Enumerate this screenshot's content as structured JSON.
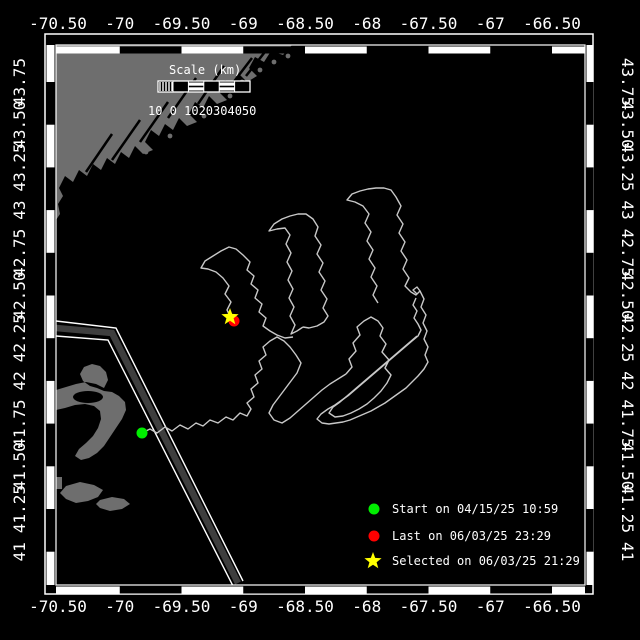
{
  "map": {
    "bg_color": "#000000",
    "land_color": "#6e6e6e",
    "track_color": "#c8c8c8",
    "lane_color": "#3e3e3e",
    "frame_color": "#ffffff",
    "plot": {
      "x0": 56,
      "y0": 45,
      "x1": 585,
      "y1": 585
    },
    "lon_axis": {
      "tick_values": [
        -70.5,
        -70,
        -69.5,
        -69,
        -68.5,
        -68,
        -67.5,
        -67,
        -66.5
      ],
      "tick_labels": [
        "-70.50",
        "-70",
        "-69.50",
        "-69",
        "-68.50",
        "-68",
        "-67.50",
        "-67",
        "-66.50"
      ],
      "x_of_first_tick": 58,
      "px_per_degree": 123.5
    },
    "lat_axis": {
      "tick_values": [
        43.75,
        43.5,
        43.25,
        43,
        42.75,
        42.5,
        42.25,
        42,
        41.75,
        41.5,
        41.25,
        41
      ],
      "tick_labels": [
        "43.75",
        "43.50",
        "43.25",
        "43",
        "42.75",
        "42.50",
        "42.25",
        "42",
        "41.75",
        "41.50",
        "41.25",
        "41"
      ],
      "y_of_first_tick": 82,
      "px_per_degree": 170.8
    }
  },
  "scale_bar": {
    "title": "Scale (km)",
    "numbers": "10 0 1020304050",
    "bar": {
      "x": 158,
      "y": 81,
      "w": 92,
      "h": 11,
      "segments": 5
    }
  },
  "legend": {
    "items": [
      {
        "marker": "circle",
        "color": "#00ee00",
        "label": "Start on 04/15/25 10:59"
      },
      {
        "marker": "circle",
        "color": "#ff0000",
        "label": "Last on 06/03/25 23:29"
      },
      {
        "marker": "star",
        "color": "#ffff00",
        "label": "Selected on 06/03/25 21:29"
      }
    ],
    "marker_x": 374,
    "text_x": 392,
    "row_y": [
      509,
      536,
      561
    ]
  },
  "markers": {
    "start": {
      "x": 142,
      "y": 433,
      "color": "#00ee00"
    },
    "last": {
      "x": 234,
      "y": 321,
      "color": "#ff0000"
    },
    "selected": {
      "x": 230,
      "y": 317,
      "color": "#ffff00"
    }
  },
  "shoreline": {
    "maine_path": "M56,45 L292,45 L283,55 271,51 264,62 255,57 249,68 257,76 247,82 239,74 233,86 225,80 219,92 227,100 217,104 209,96 203,108 195,102 189,114 197,122 187,126 179,118 173,130 165,124 159,136 151,130 145,142 153,150 143,154 135,146 129,158 121,152 115,164 107,158 101,170 93,164 87,176 79,170 73,182 65,176 59,188 63,196 58,204 60,214 56,220 Z",
    "cape_cod_path": "M56,390 L66,387 76,384 86,382 96,384 104,388 108,380 106,372 100,366 92,364 84,367 80,374 83,381 90,386 97,388 104,391 112,392 119,396 125,402 126,410 122,419 116,428 110,437 104,446 97,453 89,458 81,460 75,456 79,449 86,443 93,436 98,428 101,419 100,411 94,406 85,404 75,405 65,408 56,410 Z",
    "bay_cut": {
      "cx": 88,
      "cy": 397,
      "rx": 15,
      "ry": 6
    },
    "islands_south": [
      "M66,486 L80,482 94,485 103,490 98,497 88,501 76,503 66,499 60,493 Z",
      "M100,500 L112,497 124,499 130,504 122,509 110,511 100,508 96,504 Z",
      "M50,477 L62,477 62,489 50,489 Z"
    ],
    "coast_islands": [
      [
        260,
        70
      ],
      [
        274,
        62
      ],
      [
        288,
        56
      ],
      [
        300,
        50
      ],
      [
        242,
        82
      ],
      [
        230,
        96
      ],
      [
        204,
        116
      ],
      [
        170,
        136
      ],
      [
        146,
        152
      ]
    ],
    "rivers": [
      [
        [
          168,
          118
        ],
        [
          196,
          78
        ]
      ],
      [
        [
          140,
          142
        ],
        [
          168,
          102
        ]
      ],
      [
        [
          198,
          104
        ],
        [
          224,
          66
        ]
      ],
      [
        [
          112,
          160
        ],
        [
          140,
          120
        ]
      ],
      [
        [
          226,
          92
        ],
        [
          252,
          58
        ]
      ],
      [
        [
          86,
          172
        ],
        [
          112,
          134
        ]
      ],
      [
        [
          246,
          76
        ],
        [
          268,
          48
        ]
      ]
    ]
  },
  "traffic_lane": {
    "center": [
      [
        56,
        328
      ],
      [
        112,
        333
      ],
      [
        238,
        583
      ]
    ],
    "edge_a": [
      [
        56,
        321
      ],
      [
        116,
        328
      ],
      [
        243,
        581
      ]
    ],
    "edge_b": [
      [
        56,
        336
      ],
      [
        108,
        340
      ],
      [
        233,
        586
      ]
    ]
  },
  "track_strokes": [
    [
      [
        142,
        433
      ],
      [
        150,
        429
      ],
      [
        157,
        433
      ],
      [
        165,
        427
      ],
      [
        172,
        431
      ],
      [
        180,
        425
      ],
      [
        188,
        429
      ],
      [
        196,
        423
      ],
      [
        203,
        426
      ],
      [
        210,
        420
      ],
      [
        218,
        423
      ],
      [
        226,
        417
      ],
      [
        233,
        420
      ],
      [
        240,
        413
      ],
      [
        247,
        416
      ],
      [
        251,
        409
      ],
      [
        247,
        403
      ],
      [
        254,
        397
      ],
      [
        251,
        389
      ],
      [
        258,
        383
      ],
      [
        255,
        375
      ],
      [
        262,
        369
      ],
      [
        259,
        361
      ],
      [
        266,
        355
      ],
      [
        263,
        347
      ],
      [
        270,
        341
      ],
      [
        277,
        337
      ],
      [
        284,
        341
      ],
      [
        290,
        347
      ],
      [
        296,
        355
      ],
      [
        301,
        363
      ],
      [
        297,
        373
      ],
      [
        291,
        381
      ],
      [
        285,
        389
      ],
      [
        279,
        397
      ],
      [
        273,
        405
      ],
      [
        269,
        413
      ],
      [
        274,
        420
      ],
      [
        282,
        423
      ],
      [
        290,
        418
      ],
      [
        298,
        411
      ],
      [
        306,
        404
      ],
      [
        314,
        397
      ],
      [
        322,
        390
      ],
      [
        330,
        384
      ],
      [
        338,
        379
      ],
      [
        346,
        374
      ]
    ],
    [
      [
        231,
        318
      ],
      [
        227,
        310
      ],
      [
        231,
        302
      ],
      [
        225,
        294
      ],
      [
        229,
        286
      ],
      [
        223,
        278
      ],
      [
        216,
        272
      ],
      [
        208,
        269
      ],
      [
        201,
        268
      ],
      [
        205,
        261
      ],
      [
        213,
        256
      ],
      [
        221,
        251
      ],
      [
        229,
        247
      ],
      [
        236,
        249
      ],
      [
        243,
        255
      ],
      [
        250,
        262
      ],
      [
        247,
        270
      ],
      [
        254,
        276
      ],
      [
        251,
        284
      ],
      [
        258,
        290
      ],
      [
        255,
        298
      ],
      [
        262,
        304
      ],
      [
        259,
        312
      ],
      [
        266,
        318
      ],
      [
        263,
        326
      ],
      [
        270,
        331
      ],
      [
        277,
        335
      ],
      [
        285,
        338
      ],
      [
        293,
        337
      ]
    ],
    [
      [
        303,
        327
      ],
      [
        297,
        331
      ],
      [
        291,
        334
      ],
      [
        295,
        325
      ],
      [
        290,
        316
      ],
      [
        294,
        307
      ],
      [
        289,
        298
      ],
      [
        293,
        289
      ],
      [
        288,
        280
      ],
      [
        292,
        271
      ],
      [
        287,
        262
      ],
      [
        291,
        253
      ],
      [
        286,
        244
      ],
      [
        290,
        235
      ],
      [
        285,
        228
      ],
      [
        277,
        229
      ],
      [
        269,
        231
      ],
      [
        274,
        224
      ],
      [
        282,
        219
      ],
      [
        290,
        216
      ],
      [
        298,
        214
      ],
      [
        306,
        214
      ],
      [
        313,
        219
      ],
      [
        318,
        227
      ],
      [
        315,
        236
      ],
      [
        321,
        245
      ],
      [
        317,
        254
      ],
      [
        323,
        263
      ],
      [
        319,
        272
      ],
      [
        325,
        281
      ],
      [
        321,
        290
      ],
      [
        327,
        299
      ],
      [
        323,
        308
      ],
      [
        328,
        316
      ],
      [
        324,
        322
      ],
      [
        317,
        326
      ],
      [
        309,
        328
      ],
      [
        303,
        327
      ]
    ],
    [
      [
        378,
        303
      ],
      [
        373,
        295
      ],
      [
        377,
        286
      ],
      [
        371,
        277
      ],
      [
        375,
        268
      ],
      [
        369,
        259
      ],
      [
        373,
        250
      ],
      [
        367,
        241
      ],
      [
        371,
        232
      ],
      [
        365,
        223
      ],
      [
        369,
        214
      ],
      [
        363,
        206
      ],
      [
        355,
        202
      ],
      [
        347,
        200
      ],
      [
        352,
        194
      ],
      [
        360,
        191
      ],
      [
        368,
        189
      ],
      [
        376,
        188
      ],
      [
        384,
        188
      ],
      [
        391,
        190
      ],
      [
        396,
        197
      ],
      [
        401,
        206
      ],
      [
        397,
        215
      ],
      [
        403,
        224
      ],
      [
        399,
        233
      ],
      [
        405,
        242
      ],
      [
        401,
        251
      ],
      [
        407,
        260
      ],
      [
        403,
        269
      ],
      [
        409,
        278
      ],
      [
        405,
        286
      ],
      [
        411,
        292
      ],
      [
        416,
        295
      ],
      [
        420,
        291
      ],
      [
        417,
        287
      ],
      [
        413,
        290
      ],
      [
        417,
        294
      ]
    ],
    [
      [
        346,
        374
      ],
      [
        352,
        367
      ],
      [
        349,
        359
      ],
      [
        356,
        351
      ],
      [
        353,
        343
      ],
      [
        360,
        335
      ],
      [
        357,
        327
      ],
      [
        364,
        321
      ],
      [
        371,
        317
      ],
      [
        378,
        321
      ],
      [
        383,
        328
      ],
      [
        380,
        336
      ],
      [
        386,
        344
      ],
      [
        382,
        352
      ],
      [
        389,
        360
      ],
      [
        385,
        368
      ],
      [
        391,
        375
      ],
      [
        387,
        383
      ],
      [
        381,
        391
      ],
      [
        374,
        398
      ],
      [
        367,
        404
      ],
      [
        359,
        409
      ],
      [
        351,
        413
      ],
      [
        343,
        416
      ],
      [
        335,
        417
      ],
      [
        329,
        413
      ],
      [
        333,
        407
      ],
      [
        340,
        402
      ],
      [
        347,
        396
      ],
      [
        354,
        390
      ],
      [
        361,
        384
      ],
      [
        368,
        378
      ],
      [
        375,
        372
      ],
      [
        382,
        366
      ],
      [
        389,
        360
      ],
      [
        396,
        354
      ],
      [
        403,
        348
      ],
      [
        410,
        342
      ],
      [
        417,
        336
      ]
    ],
    [
      [
        420,
        291
      ],
      [
        424,
        299
      ],
      [
        421,
        307
      ],
      [
        426,
        315
      ],
      [
        423,
        323
      ],
      [
        427,
        331
      ],
      [
        424,
        339
      ],
      [
        428,
        347
      ],
      [
        425,
        355
      ],
      [
        428,
        362
      ],
      [
        424,
        369
      ],
      [
        418,
        376
      ],
      [
        412,
        382
      ],
      [
        406,
        388
      ],
      [
        399,
        393
      ],
      [
        392,
        398
      ],
      [
        385,
        403
      ],
      [
        378,
        407
      ],
      [
        371,
        411
      ],
      [
        364,
        414
      ],
      [
        357,
        417
      ],
      [
        350,
        420
      ],
      [
        343,
        422
      ],
      [
        336,
        423
      ],
      [
        329,
        424
      ],
      [
        322,
        423
      ],
      [
        317,
        419
      ],
      [
        321,
        414
      ],
      [
        328,
        409
      ],
      [
        335,
        405
      ],
      [
        342,
        400
      ],
      [
        349,
        395
      ],
      [
        356,
        389
      ],
      [
        363,
        383
      ],
      [
        370,
        377
      ],
      [
        377,
        371
      ],
      [
        384,
        365
      ],
      [
        391,
        359
      ],
      [
        398,
        353
      ],
      [
        405,
        347
      ],
      [
        412,
        341
      ],
      [
        418,
        336
      ],
      [
        421,
        330
      ],
      [
        418,
        324
      ],
      [
        414,
        318
      ],
      [
        417,
        311
      ],
      [
        413,
        305
      ],
      [
        416,
        298
      ]
    ]
  ]
}
